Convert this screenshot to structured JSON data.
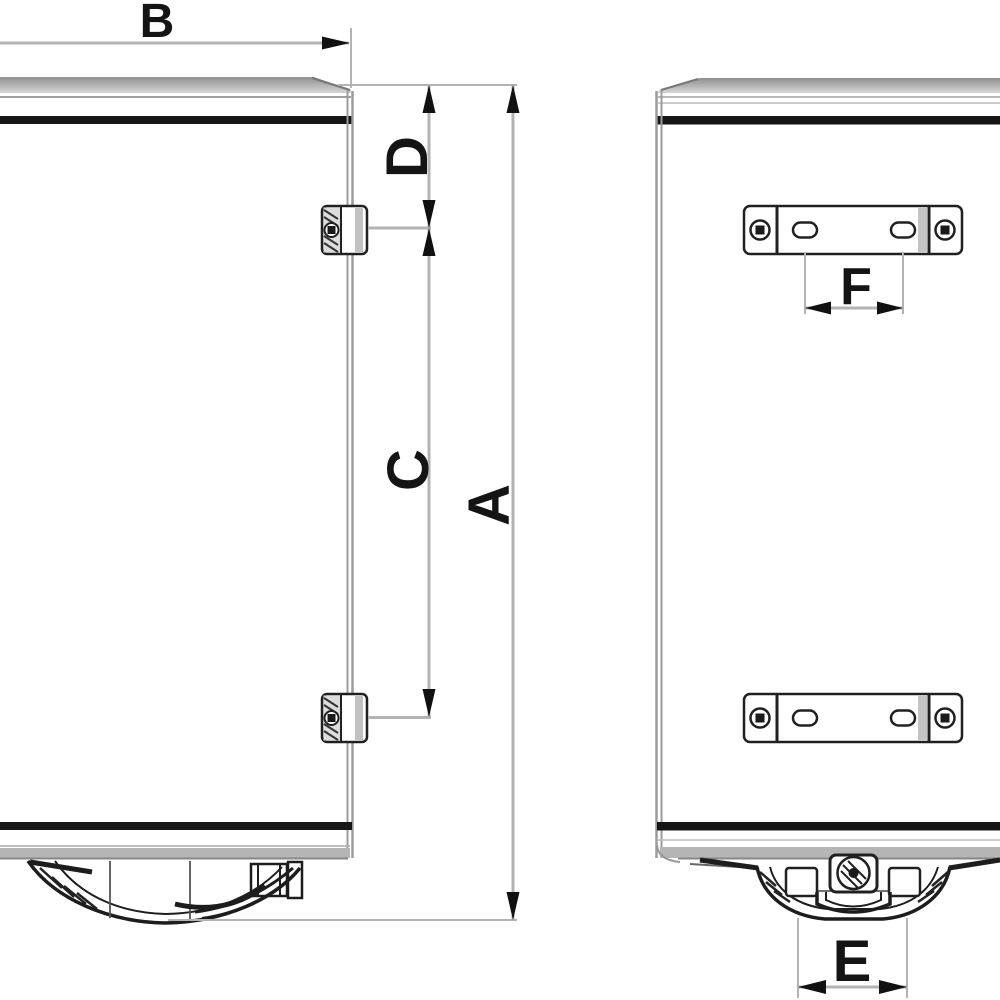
{
  "diagram": {
    "type": "technical-dimension-drawing",
    "subject": "wall-mounted electric water heater shown in side view and rear view with dimension callouts"
  },
  "dimension_labels": {
    "a": "A",
    "b": "B",
    "c": "C",
    "d": "D",
    "e": "E",
    "f": "F"
  },
  "colors": {
    "ink": "#1d1d1d",
    "band-black": "#161616",
    "metal-gray": "#9c9c9c",
    "dim-line": "#b3b3b3",
    "label-ink": "#141414",
    "background": "#ffffff"
  }
}
